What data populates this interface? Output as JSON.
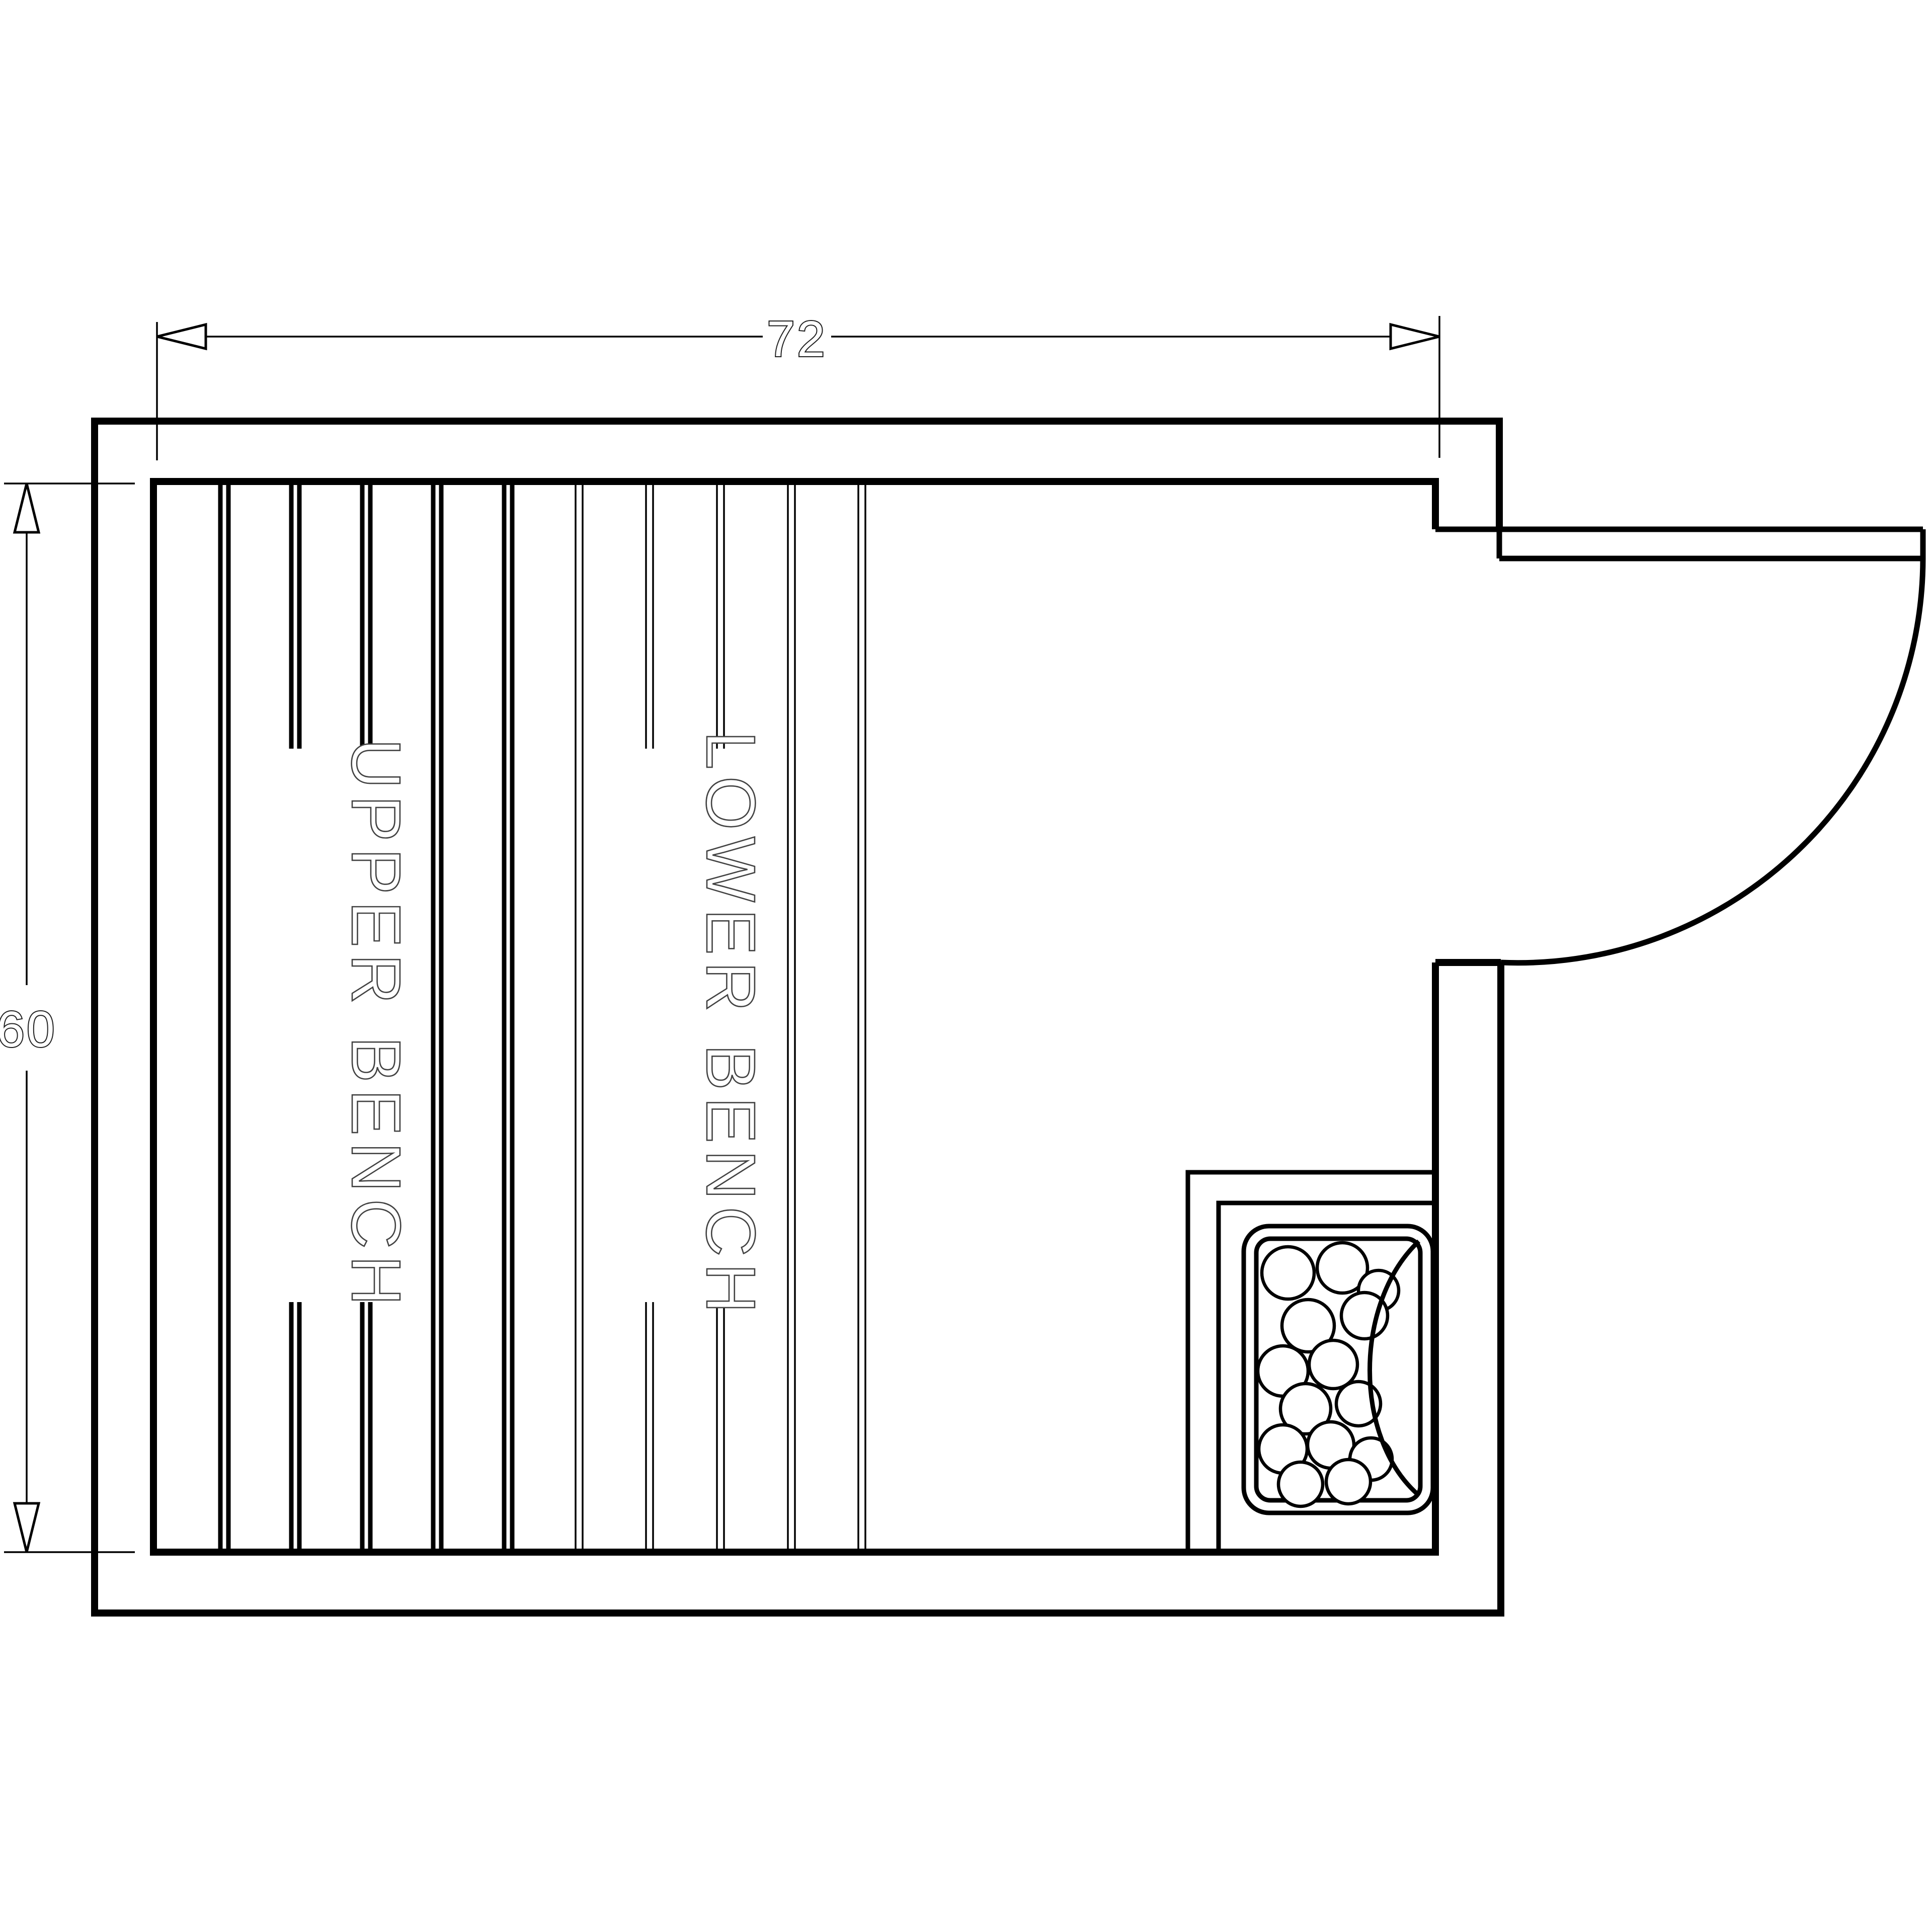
{
  "drawing": {
    "title": "sauna-floor-plan",
    "background_color": "#ffffff",
    "line_color": "#000000",
    "label_color": "#424242",
    "dimensions": {
      "width": {
        "label": "72"
      },
      "height": {
        "label": "60"
      }
    },
    "benches": {
      "upper": {
        "label": "UPPER BENCH"
      },
      "lower": {
        "label": "LOWER BENCH"
      }
    },
    "symbols": [
      "door-swing-arc",
      "door-leaf",
      "heater-stones",
      "heater-guard-rail",
      "dimension-arrowheads"
    ]
  }
}
